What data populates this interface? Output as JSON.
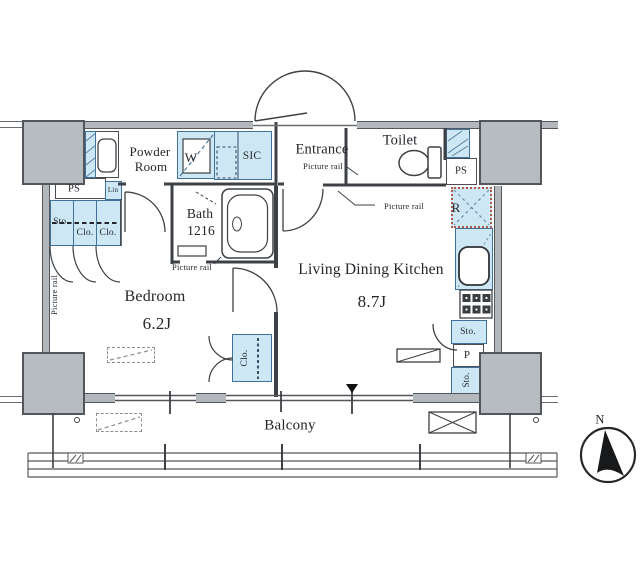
{
  "rooms": {
    "powder_line1": "Powder",
    "powder_line2": "Room",
    "entrance": "Entrance",
    "toilet": "Toilet",
    "bath_name": "Bath",
    "bath_size": "1216",
    "bedroom_name": "Bedroom",
    "bedroom_size": "6.2J",
    "ldk_name": "Living Dining Kitchen",
    "ldk_size": "8.7J",
    "balcony": "Balcony"
  },
  "fixtures": {
    "washer": "W",
    "shoe_closet": "SIC",
    "fridge": "R",
    "linen": "Lin",
    "ps_left": "PS",
    "ps_right": "PS",
    "hall_storage": "Sto.",
    "hall_closet_a": "Clo.",
    "hall_closet_b": "Clo.",
    "bedroom_closet": "Clo.",
    "kitchen_storage_a": "Sto.",
    "kitchen_pantry": "P",
    "kitchen_storage_b": "Sto."
  },
  "annotations": {
    "picture_rail_entrance": "Picture rail",
    "picture_rail_ldk": "Picture rail",
    "picture_rail_bath": "Picture rail",
    "picture_rail_bedroom": "Picture rail",
    "north": "N"
  },
  "colors": {
    "fixture_fill": "#cde7f5",
    "fixture_border": "#41729b",
    "wall_fill": "#b3b8bc",
    "wall_border": "#53575b",
    "line": "#3d4145",
    "fridge_dotted_border": "#b05a4a"
  }
}
